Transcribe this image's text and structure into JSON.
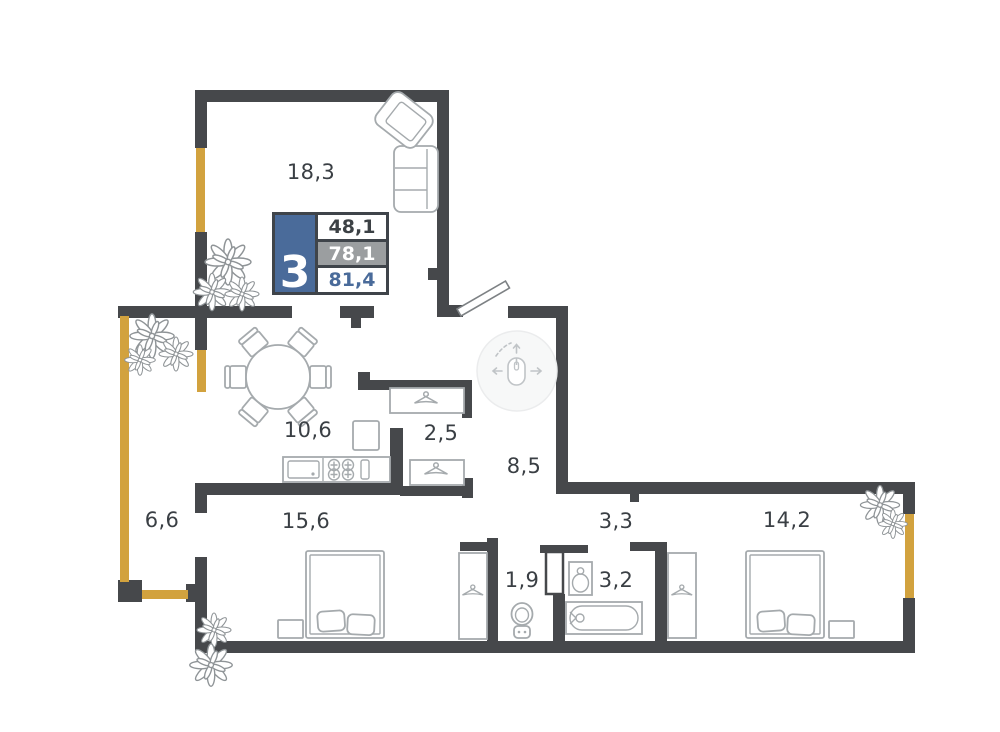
{
  "legend": {
    "rooms_count": "3",
    "values": [
      "48,1",
      "78,1",
      "81,4"
    ]
  },
  "rooms": [
    {
      "id": "living-room",
      "area": "18,3"
    },
    {
      "id": "kitchen-dining",
      "area": "10,6"
    },
    {
      "id": "closet",
      "area": "2,5"
    },
    {
      "id": "hallway",
      "area": "8,5"
    },
    {
      "id": "balcony",
      "area": "6,6"
    },
    {
      "id": "bedroom-1",
      "area": "15,6"
    },
    {
      "id": "corridor",
      "area": "3,3"
    },
    {
      "id": "bedroom-2",
      "area": "14,2"
    },
    {
      "id": "wc",
      "area": "1,9"
    },
    {
      "id": "bathroom",
      "area": "3,2"
    }
  ],
  "icons": {
    "hallway_navigation": "mouse-pan-icon"
  },
  "colors": {
    "wall": "#46484b",
    "window_accent": "#d2a23e",
    "legend_blue": "#4a6b9a",
    "legend_gray": "#9b9ea0",
    "furniture_outline": "#a5aaad"
  }
}
